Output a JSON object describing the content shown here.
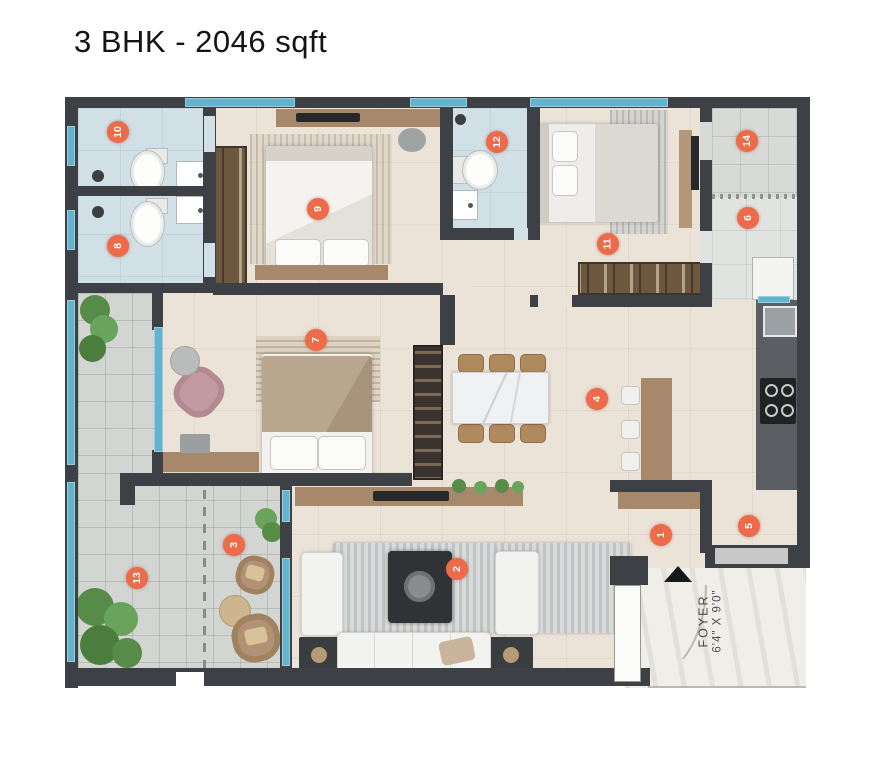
{
  "title": "3 BHK - 2046 sqft",
  "foyer": {
    "label": "FOYER",
    "dimensions": "6'4\" X 9'0\""
  },
  "markers": [
    {
      "number": "1",
      "x": 661,
      "y": 535
    },
    {
      "number": "2",
      "x": 457,
      "y": 569
    },
    {
      "number": "3",
      "x": 234,
      "y": 545
    },
    {
      "number": "4",
      "x": 597,
      "y": 399
    },
    {
      "number": "5",
      "x": 749,
      "y": 526
    },
    {
      "number": "6",
      "x": 748,
      "y": 218
    },
    {
      "number": "7",
      "x": 316,
      "y": 340
    },
    {
      "number": "8",
      "x": 118,
      "y": 246
    },
    {
      "number": "9",
      "x": 318,
      "y": 209
    },
    {
      "number": "10",
      "x": 118,
      "y": 132
    },
    {
      "number": "11",
      "x": 608,
      "y": 244
    },
    {
      "number": "12",
      "x": 497,
      "y": 142
    },
    {
      "number": "13",
      "x": 137,
      "y": 578
    },
    {
      "number": "14",
      "x": 747,
      "y": 141
    }
  ],
  "colors": {
    "marker_accent": "#ed6a4a",
    "wall": "#3d4145",
    "window_glass": "#63b3cc",
    "floor_beige": "#ebe3d8",
    "bathroom_blue": "#d0e0e6",
    "terrace_gray": "#d3d5d2",
    "wood": "#a8886a"
  }
}
